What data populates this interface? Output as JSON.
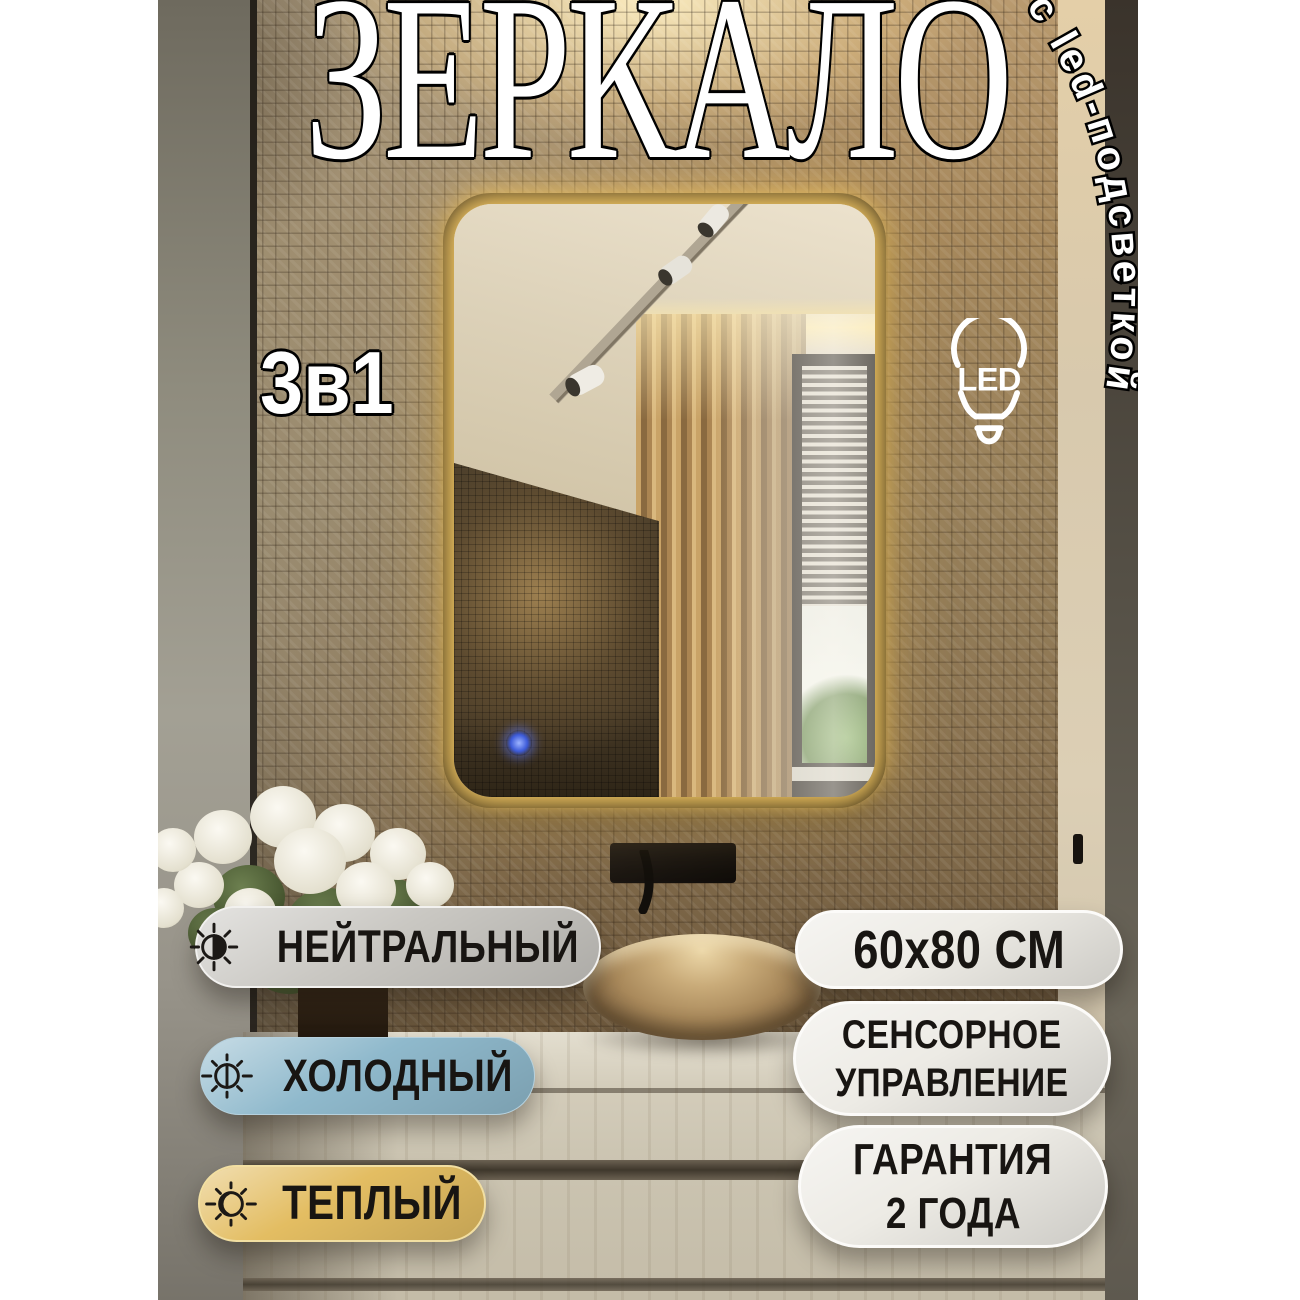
{
  "hero": {
    "title": "ЗЕРКАЛО",
    "tagline": "с led-подсветкой",
    "badge_3in1": "3в1",
    "led_label": "LED"
  },
  "light_modes": [
    {
      "label": "НЕЙТРАЛЬНЫЙ",
      "icon": "sun-half-icon",
      "color": "#c9c7c2"
    },
    {
      "label": "ХОЛОДНЫЙ",
      "icon": "sun-cold-icon",
      "color": "#8fb9cc"
    },
    {
      "label": "ТЕПЛЫЙ",
      "icon": "sun-warm-icon",
      "color": "#e3bd62"
    }
  ],
  "specs": [
    {
      "lines": [
        "60х80 СМ"
      ],
      "color": "#edebe5"
    },
    {
      "lines": [
        "СЕНСОРНОЕ",
        "УПРАВЛЕНИЕ"
      ],
      "color": "#edebe5"
    },
    {
      "lines": [
        "ГАРАНТИЯ",
        "2 ГОДА"
      ],
      "color": "#edebe5"
    }
  ],
  "mirror": {
    "frame_color": "#17130e",
    "led_glow_color": "#ffd977",
    "touch_sensor_color": "#3d5bd9"
  }
}
